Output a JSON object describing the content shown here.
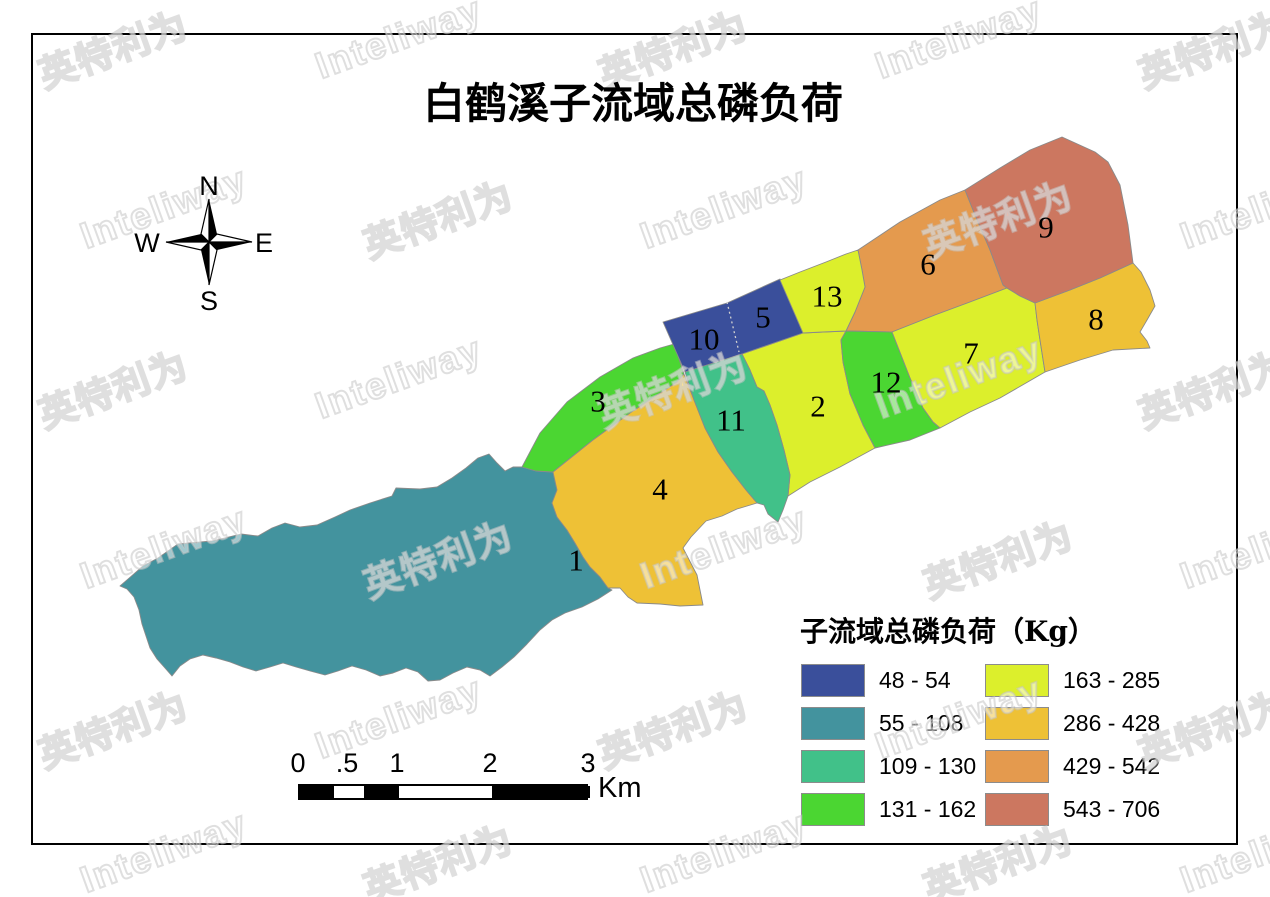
{
  "title": "白鹤溪子流域总磷负荷",
  "compass": {
    "north": "N",
    "east": "E",
    "south": "S",
    "west": "W"
  },
  "legend": {
    "title": "子流域总磷负荷（Kg）",
    "classes": [
      {
        "range": "48 - 54",
        "color": "#3A4F9B"
      },
      {
        "range": "55 - 108",
        "color": "#43939E"
      },
      {
        "range": "109 - 130",
        "color": "#41C189"
      },
      {
        "range": "131 - 162",
        "color": "#4BD632"
      },
      {
        "range": "163 - 285",
        "color": "#DCEF2C"
      },
      {
        "range": "286 - 428",
        "color": "#EEC136"
      },
      {
        "range": "429 - 542",
        "color": "#E49A4E"
      },
      {
        "range": "543 - 706",
        "color": "#CC7760"
      }
    ]
  },
  "scalebar": {
    "unit": "Km",
    "labels": [
      {
        "text": "0",
        "x": 298
      },
      {
        "text": ".5",
        "x": 347
      },
      {
        "text": "1",
        "x": 397
      },
      {
        "text": "2",
        "x": 490
      },
      {
        "text": "3",
        "x": 588
      }
    ],
    "bar": {
      "x": 298,
      "y": 784,
      "height": 16,
      "end": 588
    },
    "segments": [
      {
        "x1": 298,
        "x2": 332,
        "fill": "#000000"
      },
      {
        "x1": 332,
        "x2": 362,
        "fill": "#ffffff"
      },
      {
        "x1": 362,
        "x2": 397,
        "fill": "#000000"
      },
      {
        "x1": 397,
        "x2": 490,
        "fill": "#ffffff"
      },
      {
        "x1": 490,
        "x2": 588,
        "fill": "#000000"
      }
    ]
  },
  "watermark": {
    "texts": [
      "英特利为",
      "Inteliway"
    ],
    "cols": [
      30,
      310,
      590,
      870,
      1130
    ],
    "rows": [
      48,
      218,
      388,
      558,
      728,
      862
    ],
    "row_offset": 45,
    "rotation_deg": -20
  },
  "map": {
    "stroke": "#8a8a8a",
    "divider": {
      "x1": 727,
      "y1": 302,
      "x2": 739,
      "y2": 352
    },
    "regions": [
      {
        "id": "1",
        "value_class": 1,
        "label_x": 576,
        "label_y": 560,
        "points": "120,586 143,566 158,558 178,544 212,541 225,538 241,534 258,536 272,528 285,523 300,527 317,525 335,517 350,510 370,503 392,496 396,488 420,489 437,487 452,478 466,468 478,458 489,454 497,463 505,471 513,467 522,467 536,471 553,472 557,490 552,503 557,517 567,530 575,543 583,557 590,567 600,577 608,588 612,590 598,599 582,607 565,613 552,620 540,630 527,644 514,657 502,667 490,676 480,670 467,667 453,673 440,680 428,681 418,672 406,668 393,673 380,676 366,670 352,666 338,671 325,675 310,671 296,667 283,663 270,667 256,671 243,667 230,662 216,658 203,655 190,659 180,666 172,676 165,668 157,659 150,648 146,636 142,624 139,610 134,597 127,589"
      },
      {
        "id": "2",
        "value_class": 4,
        "label_x": 818,
        "label_y": 406,
        "points": "742,354 803,333 823,332 846,331 841,340 843,362 850,394 863,425 875,448 840,467 810,482 788,496 790,475 784,450 777,425 770,405 764,391 757,387 750,370"
      },
      {
        "id": "3",
        "value_class": 3,
        "label_x": 598,
        "label_y": 401,
        "points": "522,467 540,433 567,402 600,377 633,358 660,348 674,344 684,374 677,382 657,395 630,413 593,440 553,472 536,471"
      },
      {
        "id": "4",
        "value_class": 5,
        "label_x": 660,
        "label_y": 489,
        "points": "553,472 593,440 630,413 657,395 677,382 684,374 694,400 705,428 718,452 732,472 746,490 757,503 737,509 722,516 706,521 691,537 683,548 697,575 703,605 680,606 660,604 637,603 628,597 620,588 608,588 600,577 590,567 583,557 575,543 567,530 557,517 552,503 557,490"
      },
      {
        "id": "5",
        "value_class": 0,
        "label_x": 763,
        "label_y": 317,
        "points": ""
      },
      {
        "id": "6",
        "value_class": 6,
        "label_x": 928,
        "label_y": 264,
        "points": "858,250 900,222 940,200 965,190 975,215 990,250 1003,285 1007,288 970,302 935,315 892,332 846,331 855,312 865,287 862,270"
      },
      {
        "id": "7",
        "value_class": 4,
        "label_x": 971,
        "label_y": 353,
        "points": "892,332 935,315 970,302 1007,288 1020,296 1035,303 1037,320 1040,340 1045,372 1000,398 970,412 940,428 933,422 923,408 910,378"
      },
      {
        "id": "8",
        "value_class": 5,
        "label_x": 1096,
        "label_y": 319,
        "points": "1035,303 1070,290 1100,278 1133,263 1141,272 1150,290 1155,306 1147,320 1140,332 1147,341 1150,348 1113,350 1080,360 1045,372 1040,340 1037,320"
      },
      {
        "id": "9",
        "value_class": 7,
        "label_x": 1046,
        "label_y": 227,
        "points": "965,190 1000,168 1030,150 1062,137 1095,152 1108,162 1120,185 1128,225 1133,263 1100,278 1070,290 1035,303 1020,296 1007,288 1003,285 990,250 975,215"
      },
      {
        "id": "10",
        "value_class": 0,
        "label_x": 704,
        "label_y": 339,
        "points": "663,322 727,303 780,279 803,333 742,354 685,372"
      },
      {
        "id": "11",
        "value_class": 2,
        "label_x": 731,
        "label_y": 420,
        "points": "685,372 742,354 750,370 757,387 764,391 770,405 777,425 784,450 790,475 788,496 783,510 778,522 768,514 764,505 757,503 746,490 732,472 718,452 705,428 694,400"
      },
      {
        "id": "12",
        "value_class": 3,
        "label_x": 886,
        "label_y": 382,
        "points": "846,331 892,332 910,378 923,408 933,422 940,428 910,440 875,448 863,425 850,394 843,362 841,340"
      },
      {
        "id": "13",
        "value_class": 4,
        "label_x": 827,
        "label_y": 296,
        "points": "780,280 800,272 826,262 846,254 858,250 862,270 865,287 855,312 846,331 823,332 803,333"
      }
    ]
  }
}
